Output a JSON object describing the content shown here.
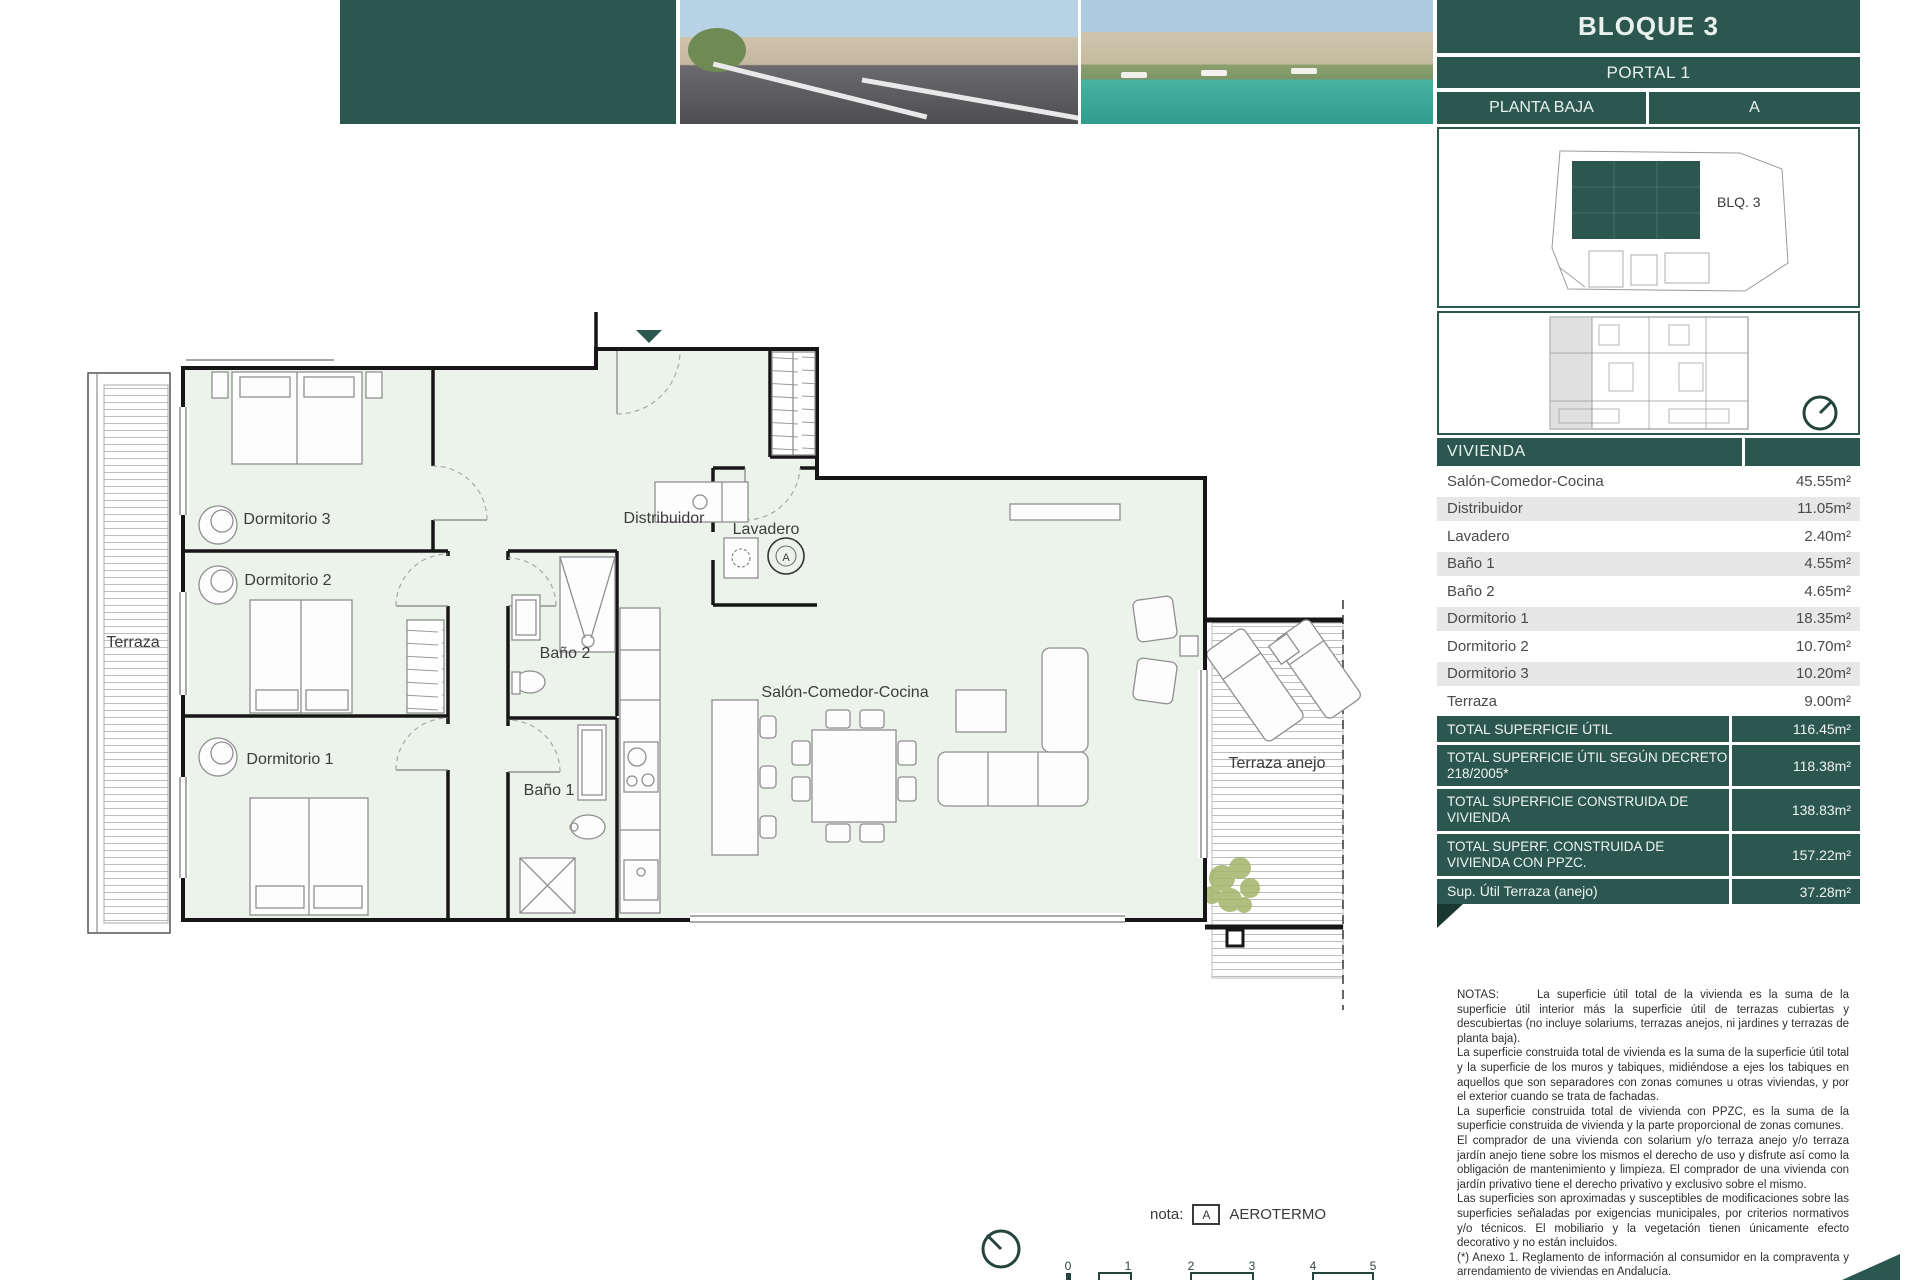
{
  "header": {
    "bloque": "BLOQUE 3",
    "portal": "PORTAL 1",
    "planta": "PLANTA BAJA",
    "letra": "A",
    "blq_label": "BLQ. 3"
  },
  "table": {
    "header": "VIVIENDA",
    "rows": [
      {
        "label": "Salón-Comedor-Cocina",
        "value": "45.55m²"
      },
      {
        "label": "Distribuidor",
        "value": "11.05m²"
      },
      {
        "label": "Lavadero",
        "value": "2.40m²"
      },
      {
        "label": "Baño 1",
        "value": "4.55m²"
      },
      {
        "label": "Baño 2",
        "value": "4.65m²"
      },
      {
        "label": "Dormitorio 1",
        "value": "18.35m²"
      },
      {
        "label": "Dormitorio 2",
        "value": "10.70m²"
      },
      {
        "label": "Dormitorio 3",
        "value": "10.20m²"
      },
      {
        "label": "Terraza",
        "value": "9.00m²"
      }
    ],
    "totals": [
      {
        "label": "TOTAL SUPERFICIE ÚTIL",
        "value": "116.45m²"
      },
      {
        "label": "TOTAL SUPERFICIE ÚTIL SEGÚN DECRETO 218/2005*",
        "value": "118.38m²"
      },
      {
        "label": "TOTAL SUPERFICIE CONSTRUIDA DE VIVIENDA",
        "value": "138.83m²"
      },
      {
        "label": "TOTAL SUPERF. CONSTRUIDA DE VIVIENDA CON PPZC.",
        "value": "157.22m²"
      },
      {
        "label": "Sup. Útil Terraza (anejo)",
        "value": "37.28m²"
      }
    ]
  },
  "plan": {
    "terraza": "Terraza",
    "dormitorio1": "Dormitorio 1",
    "dormitorio2": "Dormitorio 2",
    "dormitorio3": "Dormitorio 3",
    "distribuidor": "Distribuidor",
    "lavadero": "Lavadero",
    "bano1": "Baño 1",
    "bano2": "Baño 2",
    "salon": "Salón-Comedor-Cocina",
    "terraza_anejo": "Terraza anejo",
    "aerotermo_symbol": "A"
  },
  "nota": {
    "label": "nota:",
    "symbol": "A",
    "text": "AEROTERMO"
  },
  "scale": {
    "ticks": [
      "0",
      "1",
      "2",
      "3",
      "4",
      "5"
    ]
  },
  "notes": {
    "title": "NOTAS:",
    "paragraphs": [
      "La superficie útil total de la vivienda es la suma de la superficie útil interior más la superficie útil de terrazas cubiertas y descubiertas (no incluye solariums, terrazas anejos, ni jardines y terrazas de planta baja).",
      "La superficie construida total de vivienda es la suma de la superficie útil total y la superficie de los muros y tabiques, midiéndose a ejes los tabiques en aquellos que son separadores con zonas comunes u otras viviendas, y por el exterior cuando se trata de fachadas.",
      "La superficie construida total de vivienda con PPZC, es la suma de la superficie construida de vivienda y la parte proporcional de zonas comunes.",
      "El comprador de una vivienda con solarium y/o terraza anejo y/o terraza jardín anejo tiene sobre los mismos el derecho de uso y disfrute así como la obligación de mantenimiento y limpieza. El comprador de una vivienda con jardín privativo tiene el derecho privativo y exclusivo sobre el mismo.",
      "Las superficies son aproximadas y susceptibles de modificaciones sobre las superficies señaladas por exigencias municipales, por criterios normativos y/o técnicos. El mobiliario y la vegetación tienen únicamente efecto decorativo y no están incluidos.",
      "(*) Anexo 1. Reglamento de información al consumidor en la compraventa y arrendamiento de viviendas en Andalucía."
    ]
  },
  "colors": {
    "teal": "#2c574f",
    "plan_fill": "#ecf3eb"
  }
}
